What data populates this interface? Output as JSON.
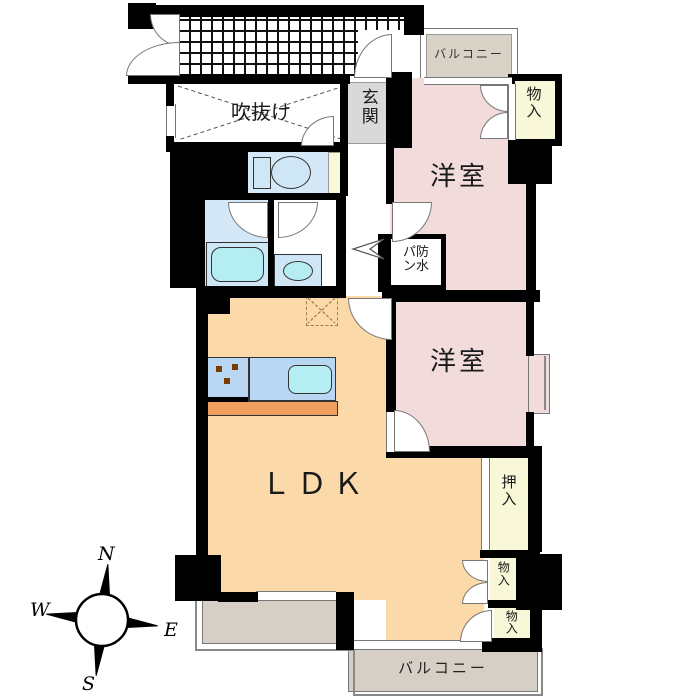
{
  "plan": {
    "rooms": {
      "balcony_top": "バルコニー",
      "atrium": "吹抜け",
      "entrance": "玄関",
      "bedroom1": "洋室",
      "storage_top": "物入",
      "laundry_pan_line1": "パ防",
      "laundry_pan_line2": "ン水",
      "bedroom2": "洋室",
      "ldk": "ＬＤＫ",
      "closet": "押入",
      "storage_mid": "物入",
      "storage_bottom": "物入",
      "balcony_bottom": "バルコニー"
    },
    "compass": {
      "n": "N",
      "e": "E",
      "s": "S",
      "w": "W"
    },
    "colors": {
      "wall": "#000000",
      "bedroom": "#f2dbdb",
      "ldk": "#fcd9a9",
      "storage": "#f8f8d8",
      "balcony": "#d6cfc6",
      "balcony_top": "#d9d2c7",
      "entrance": "#d9d9d9",
      "bath": "#d4e8f7",
      "fixture": "#b5eef2",
      "counter": "#b9d6f2",
      "kitchen_strip": "#ef9f5f"
    }
  }
}
